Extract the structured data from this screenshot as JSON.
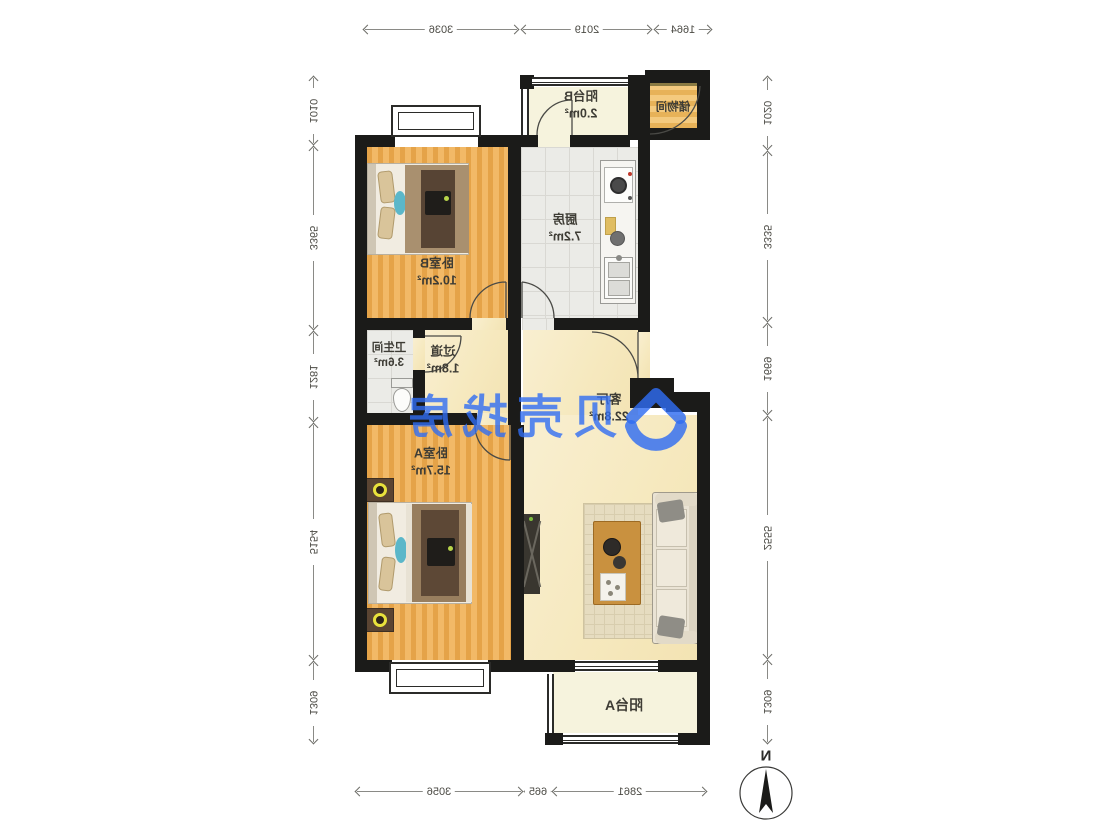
{
  "rooms": {
    "bedroom_b": {
      "name": "卧室B",
      "area": "10.2m²"
    },
    "kitchen": {
      "name": "厨房",
      "area": "7.2m²"
    },
    "balcony_b": {
      "name": "阳台B",
      "area": "2.0m²"
    },
    "storage": {
      "name": "储物间"
    },
    "bathroom": {
      "name": "卫生间",
      "area": "3.6m²"
    },
    "hallway": {
      "name": "过道",
      "area": "1.8m²"
    },
    "living": {
      "name": "客厅",
      "area": "22.8m²"
    },
    "bedroom_a": {
      "name": "卧室A",
      "area": "15.7m²"
    },
    "balcony_a": {
      "name": "阳台A"
    }
  },
  "dimensions": {
    "top": [
      "3036",
      "2019",
      "1664"
    ],
    "bottom": [
      "3056",
      "665",
      "2861"
    ],
    "left": [
      "1010",
      "3365",
      "1281",
      "5154",
      "1309"
    ],
    "right": [
      "1020",
      "3335",
      "1669",
      "2555",
      "1309"
    ]
  },
  "watermark": {
    "text": "贝壳找房",
    "color": "#2f6df2"
  },
  "compass": {
    "label": "N"
  },
  "palette": {
    "wall": "#1b1b19",
    "wood": "#eeb05a",
    "tile": "#ebebe7",
    "living_floor": "#f8edca",
    "balcony_floor": "#f6f3dd",
    "accent_blue": "#2f6df2"
  }
}
